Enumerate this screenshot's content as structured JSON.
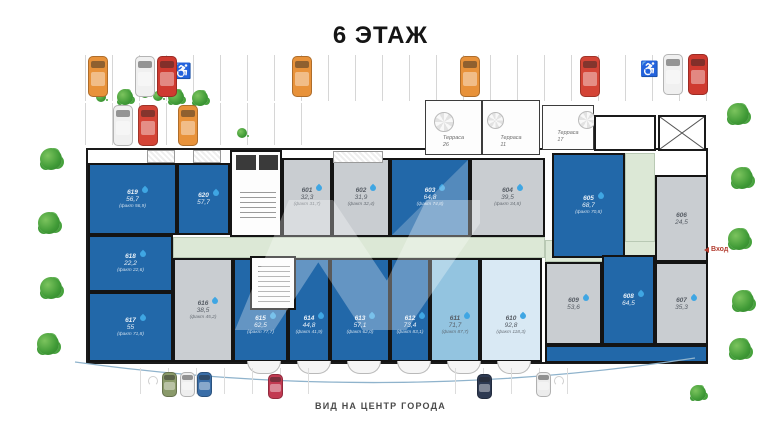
{
  "title": "6 ЭТАЖ",
  "bottom_label": "ВИД НА ЦЕНТР ГОРОДА",
  "entrance": {
    "label": "Вход"
  },
  "icons": {
    "wheelchair": "♿"
  },
  "terraces": [
    {
      "name": "Терраса",
      "area": "26"
    },
    {
      "name": "Терраса",
      "area": "11"
    },
    {
      "name": "Терраса",
      "area": "17"
    }
  ],
  "units": {
    "u601": {
      "num": "601",
      "area": "32,3",
      "fact": "(факт 31,7)"
    },
    "u602": {
      "num": "602",
      "area": "31,9",
      "fact": "(факт 32,4)"
    },
    "u603": {
      "num": "603",
      "area": "64,8",
      "fact": "(факт 74,8)"
    },
    "u604": {
      "num": "604",
      "area": "39,5",
      "fact": "(факт 34,8)"
    },
    "u605": {
      "num": "605",
      "area": "68,7",
      "fact": "(факт 70,8)"
    },
    "u606": {
      "num": "606",
      "area": "24,5",
      "fact": ""
    },
    "u607": {
      "num": "607",
      "area": "35,3",
      "fact": ""
    },
    "u608": {
      "num": "608",
      "area": "64,5",
      "fact": ""
    },
    "u609": {
      "num": "609",
      "area": "53,6",
      "fact": ""
    },
    "u610": {
      "num": "610",
      "area": "92,8",
      "fact": "(факт 118,3)"
    },
    "u611": {
      "num": "611",
      "area": "71,7",
      "fact": "(факт 87,7)"
    },
    "u612": {
      "num": "612",
      "area": "73,4",
      "fact": "(факт 83,1)"
    },
    "u613": {
      "num": "613",
      "area": "57,1",
      "fact": "(факт 62,0)"
    },
    "u614": {
      "num": "614",
      "area": "44,8",
      "fact": "(факт 41,9)"
    },
    "u615": {
      "num": "615",
      "area": "62,5",
      "fact": "(факт 77,7)"
    },
    "u616": {
      "num": "616",
      "area": "38,5",
      "fact": "(факт 45,2)"
    },
    "u617": {
      "num": "617",
      "area": "55",
      "fact": "(факт 71,8)"
    },
    "u618": {
      "num": "618",
      "area": "22,2",
      "fact": "(факт 22,6)"
    },
    "u619": {
      "num": "619",
      "area": "56,7",
      "fact": "(факт 56,9)"
    },
    "u620": {
      "num": "620",
      "area": "57,7",
      "fact": ""
    }
  },
  "colors": {
    "unit_blue": "#2268a9",
    "unit_gray": "#c9cdd1",
    "unit_lightblue": "#93c4e0",
    "unit_palest": "#d9e9f4",
    "corridor_green": "#dce8d6",
    "drop_blue": "#3fa6e3",
    "entrance_red": "#b23b2e"
  },
  "parking": {
    "cars": [
      {
        "x": 88,
        "y": 56,
        "s": "lg",
        "c": "#e8923a"
      },
      {
        "x": 135,
        "y": 56,
        "s": "lg",
        "c": "#f0f0f0"
      },
      {
        "x": 157,
        "y": 56,
        "s": "lg",
        "c": "#cf3a30"
      },
      {
        "x": 292,
        "y": 56,
        "s": "lg",
        "c": "#e8923a"
      },
      {
        "x": 460,
        "y": 56,
        "s": "lg",
        "c": "#e8923a"
      },
      {
        "x": 580,
        "y": 56,
        "s": "lg",
        "c": "#d44436"
      },
      {
        "x": 663,
        "y": 54,
        "s": "lg",
        "c": "#f0f0f0"
      },
      {
        "x": 688,
        "y": 54,
        "s": "lg",
        "c": "#cf3a30"
      },
      {
        "x": 113,
        "y": 105,
        "s": "lg",
        "c": "#f0f0f0"
      },
      {
        "x": 138,
        "y": 105,
        "s": "lg",
        "c": "#d44436"
      },
      {
        "x": 178,
        "y": 105,
        "s": "lg",
        "c": "#e8923a"
      },
      {
        "x": 162,
        "y": 372,
        "s": "sm",
        "c": "#8a9a6a"
      },
      {
        "x": 180,
        "y": 372,
        "s": "sm",
        "c": "#eeeeee"
      },
      {
        "x": 197,
        "y": 372,
        "s": "sm",
        "c": "#3a6ea8"
      },
      {
        "x": 268,
        "y": 374,
        "s": "sm",
        "c": "#c23a52"
      },
      {
        "x": 477,
        "y": 374,
        "s": "sm",
        "c": "#2e3a52"
      },
      {
        "x": 536,
        "y": 372,
        "s": "sm",
        "c": "#ececec"
      }
    ]
  }
}
